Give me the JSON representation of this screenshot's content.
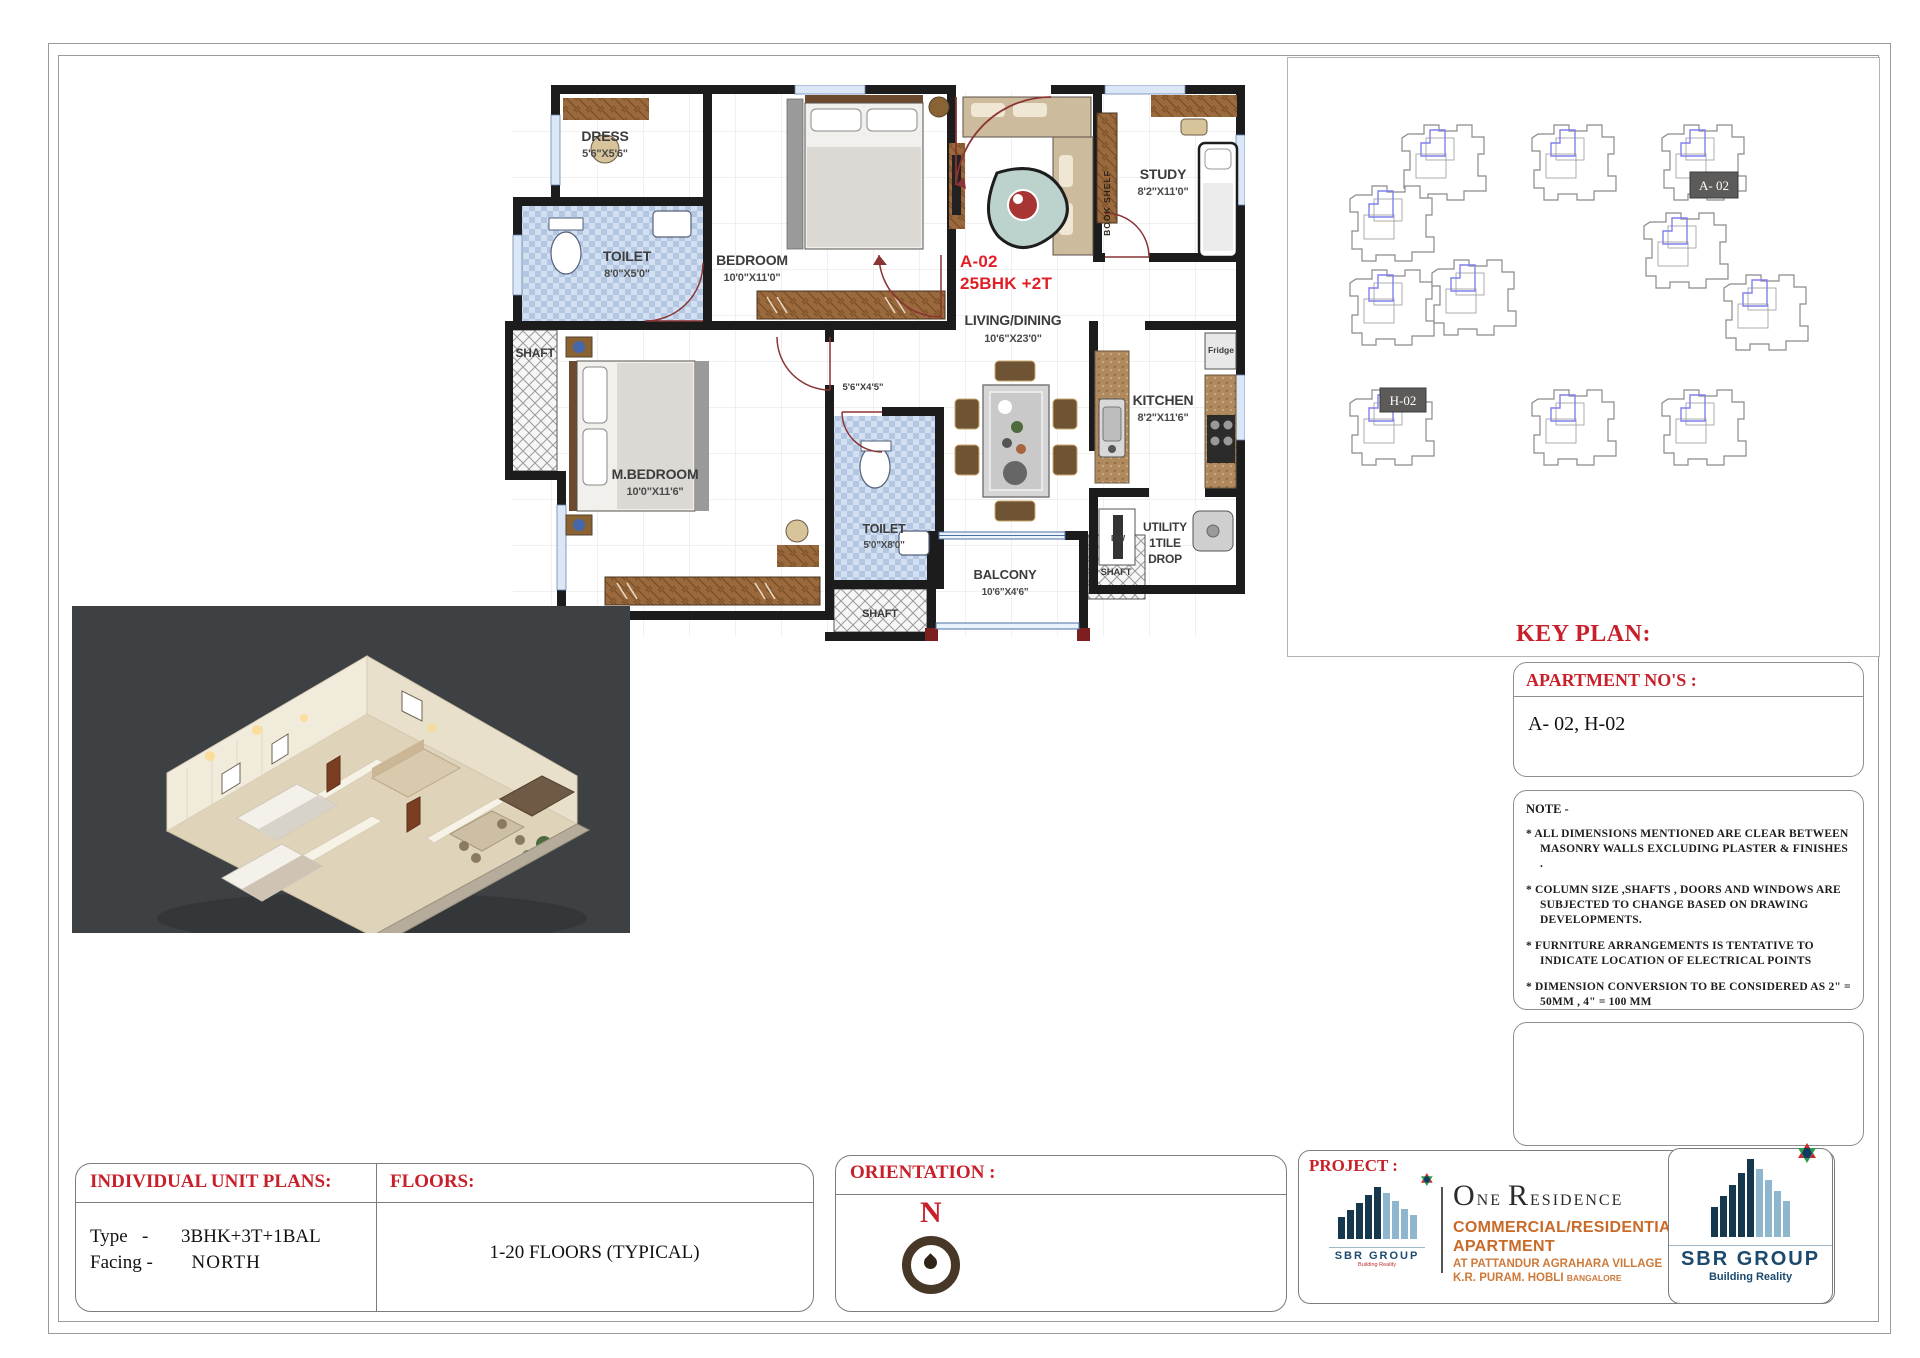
{
  "floor_plan": {
    "unit_code": "A-02",
    "unit_type": "25BHK +2T",
    "passage_dims": "5'6\"X4'5\"",
    "rooms": {
      "dress": {
        "name": "DRESS",
        "dims": "5'6\"X5'6\""
      },
      "toilet1": {
        "name": "TOILET",
        "dims": "8'0\"X5'0\""
      },
      "bedroom": {
        "name": "BEDROOM",
        "dims": "10'0\"X11'0\""
      },
      "shaft1": {
        "name": "SHAFT"
      },
      "mbedroom": {
        "name": "M.BEDROOM",
        "dims": "10'0\"X11'6\""
      },
      "toilet2": {
        "name": "TOILET",
        "dims": "5'0\"X8'0\""
      },
      "shaft2": {
        "name": "SHAFT"
      },
      "living": {
        "name": "LIVING/DINING",
        "dims": "10'6\"X23'0\""
      },
      "balcony": {
        "name": "BALCONY",
        "dims": "10'6\"X4'6\""
      },
      "shaft3": {
        "name": "SHAFT"
      },
      "study": {
        "name": "STUDY",
        "dims": "8'2\"X11'0\""
      },
      "kitchen": {
        "name": "KITCHEN",
        "dims": "8'2\"X11'6\""
      }
    },
    "utility_lines": [
      "UTILITY",
      "1TILE",
      "DROP"
    ],
    "fixtures": {
      "fridge": "Fridge",
      "dishwasher": "DW",
      "book_shelf": "BOOK SHELF"
    }
  },
  "key_plan": {
    "title": "KEY PLAN:",
    "tag_a": "A- 02",
    "tag_h": "H-02"
  },
  "apartment_nos": {
    "title": "APARTMENT NO'S :",
    "value": "A- 02, H-02"
  },
  "note": {
    "title": "NOTE -",
    "items": [
      "* ALL DIMENSIONS MENTIONED ARE CLEAR BETWEEN MASONRY WALLS EXCLUDING PLASTER & FINISHES .",
      "* COLUMN SIZE  ,SHAFTS , DOORS AND WINDOWS ARE SUBJECTED   TO CHANGE BASED ON DRAWING DEVELOPMENTS.",
      "* FURNITURE ARRANGEMENTS IS TENTATIVE TO INDICATE LOCATION OF ELECTRICAL POINTS",
      "* DIMENSION CONVERSION TO BE CONSIDERED AS 2\" = 50MM , 4\" = 100 MM"
    ]
  },
  "title_block": {
    "unit_plans_label": "INDIVIDUAL UNIT PLANS:",
    "type_label": "Type   -",
    "type_value": "3BHK+3T+1BAL",
    "facing_label": "Facing -",
    "facing_value": "NORTH",
    "floors_label": "FLOORS:",
    "floors_value": "1-20 FLOORS (TYPICAL)",
    "orientation_label": "ORIENTATION :",
    "north_letter": "N",
    "project_label": "PROJECT :"
  },
  "project": {
    "name_o": "O",
    "name_ne": "NE",
    "name_r": "R",
    "name_esidence": "ESIDENCE",
    "line1": "COMMERCIAL/RESIDENTIAL",
    "line2": "APARTMENT",
    "addr1": "AT PATTANDUR AGRAHARA VILLAGE",
    "addr2": "K.R. PURAM. HOBLI ",
    "addr2b": "BANGALORE"
  },
  "brand": {
    "name": "SBR GROUP",
    "tagline": "Building Reality"
  },
  "colors": {
    "plan_red": "#e01f26",
    "header_red": "#c8202a",
    "wall_black": "#1c1c1c",
    "tile_blue": "#c3d4ea",
    "wood_brown": "#95663a",
    "brand_navy": "#1c4a6e",
    "render_bg": "#3e4144"
  }
}
